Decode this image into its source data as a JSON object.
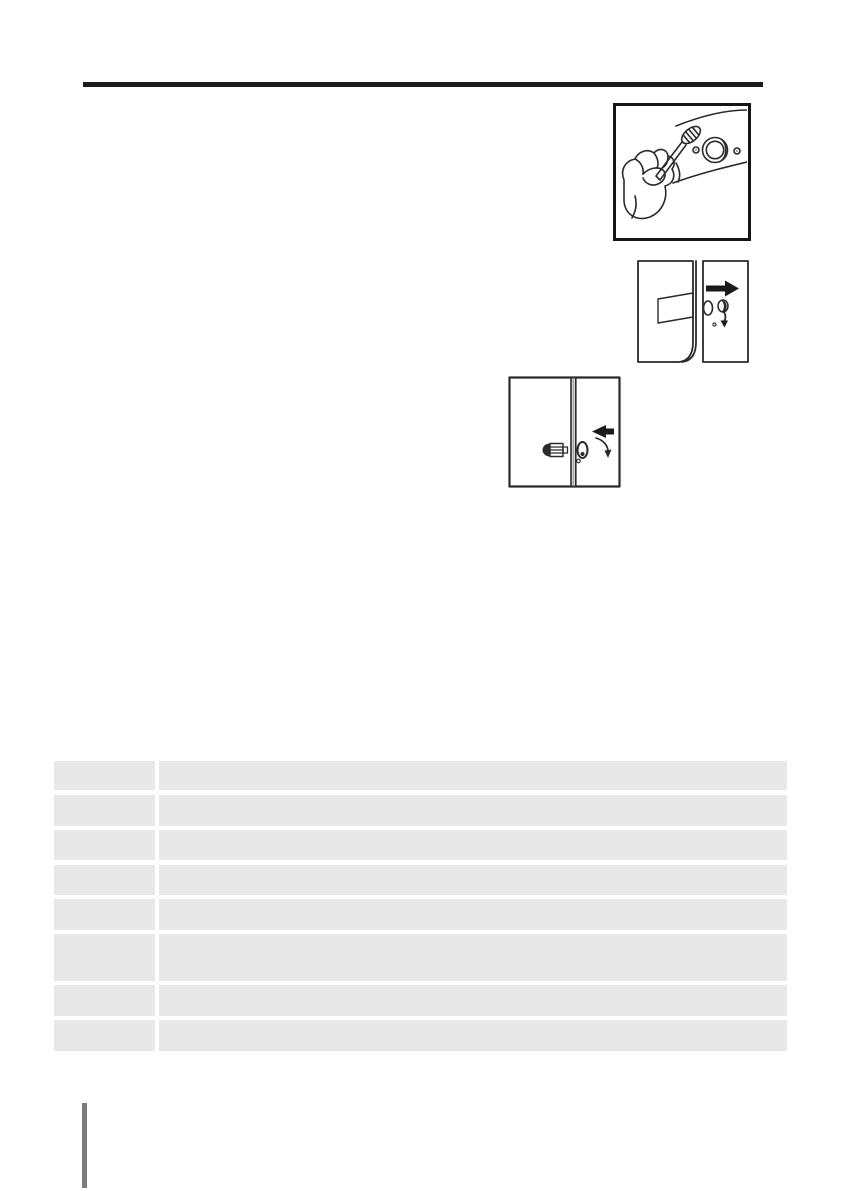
{
  "page": {
    "background": "#ffffff"
  },
  "header": {
    "divider_rule_color": "#1c1c1c"
  },
  "figures": [
    {
      "icon": "hand-brush-cleaning-round-fitting-illustration",
      "framed": true
    },
    {
      "icon": "double-door-panels-right-arrow-hole-plug-illustration",
      "framed": false
    },
    {
      "icon": "door-gap-plug-hole-left-arrow-rotate-arrow-illustration",
      "framed": false
    }
  ],
  "line_art_color": "#2a2a2a",
  "table": {
    "columns": 2,
    "cell_fill": "#e8e8e8",
    "rows": [
      [
        "",
        ""
      ],
      [
        "",
        ""
      ],
      [
        "",
        ""
      ],
      [
        "",
        ""
      ],
      [
        "",
        ""
      ],
      [
        "",
        ""
      ],
      [
        "",
        ""
      ],
      [
        "",
        ""
      ]
    ]
  },
  "footer": {
    "edge_bar_color": "#7c7c7c"
  }
}
